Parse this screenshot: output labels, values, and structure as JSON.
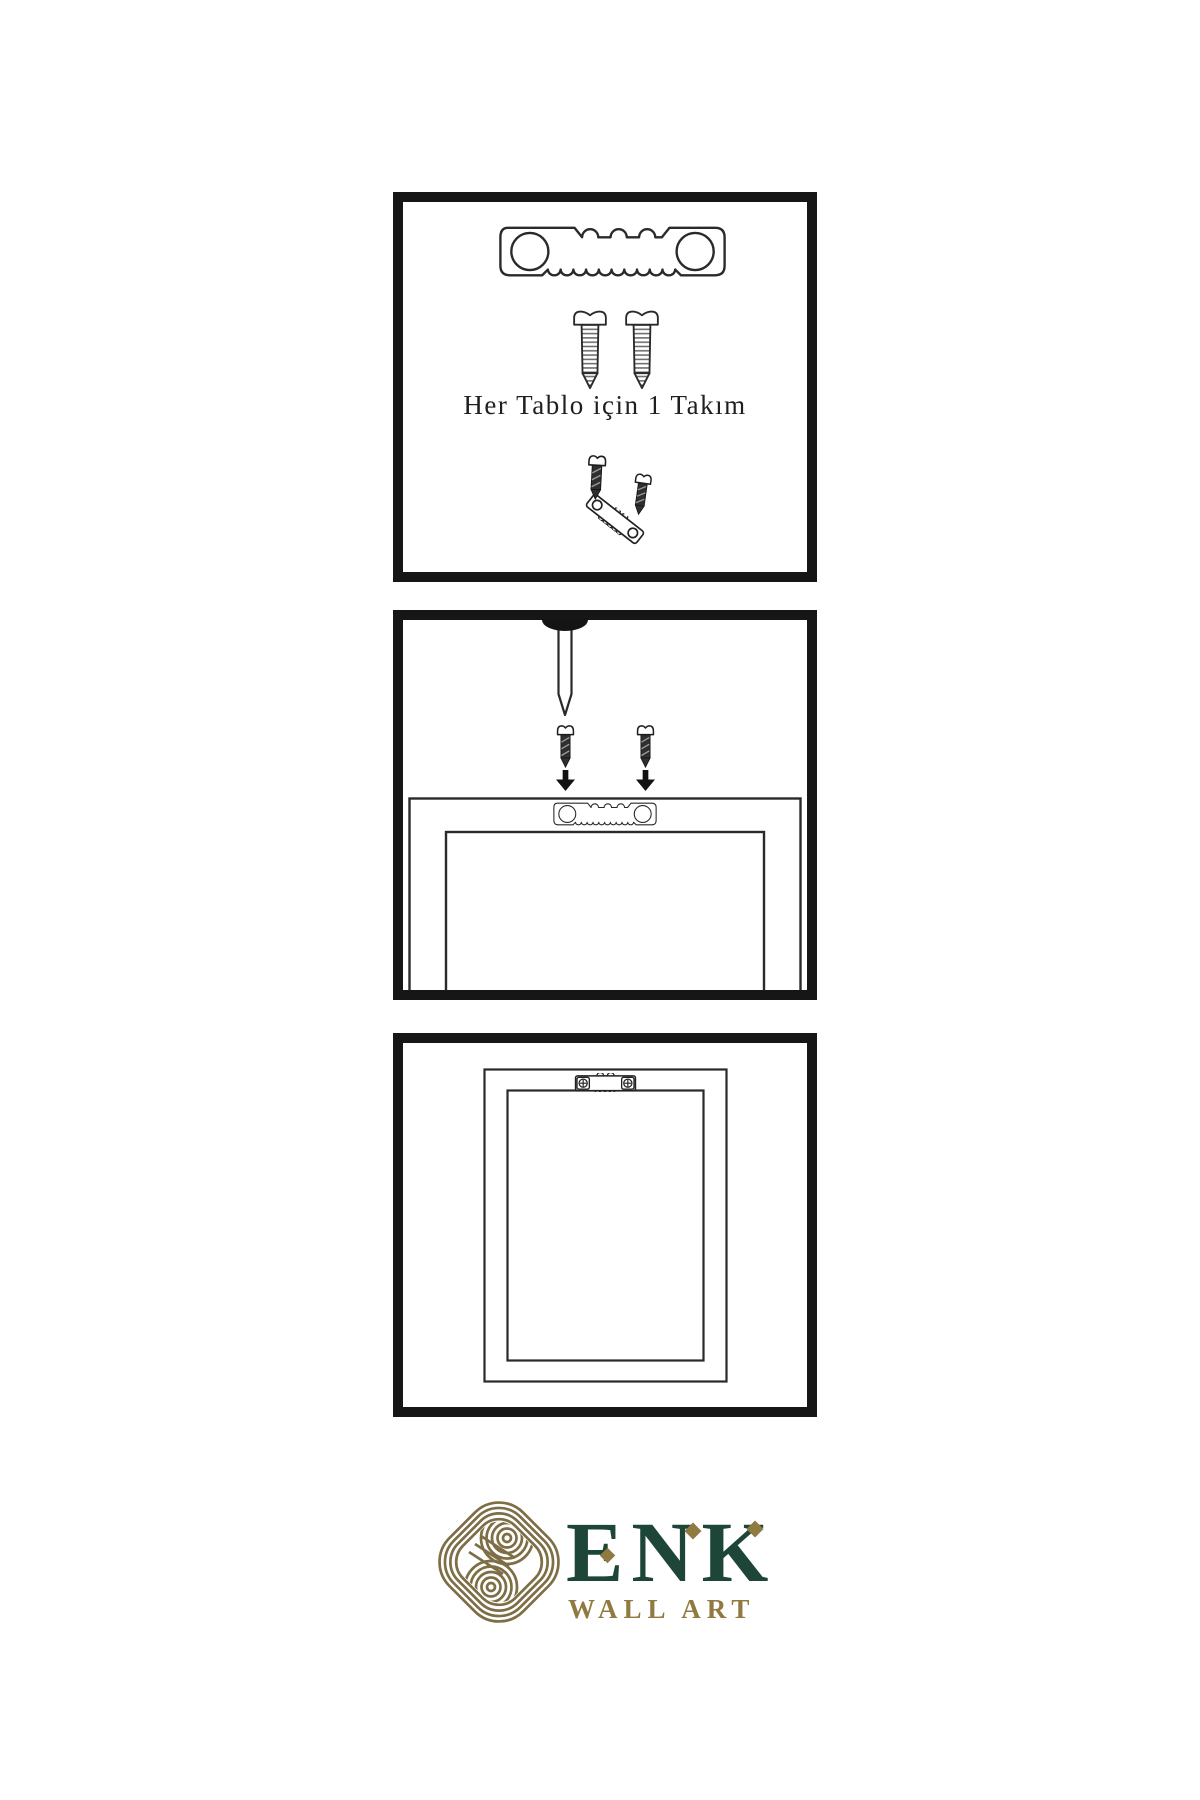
{
  "page": {
    "background": "#ffffff"
  },
  "panels": {
    "kit": {
      "caption": "Her Tablo için 1 Takım",
      "icons": [
        "sawtooth-hanger",
        "screw",
        "screw",
        "screw-into-hanger-demo"
      ]
    },
    "mount": {
      "icons": [
        "wall-nail",
        "dark-screw",
        "dark-screw",
        "down-arrow",
        "down-arrow",
        "frame-back-with-sawtooth-hanger"
      ]
    },
    "hang": {
      "icons": [
        "hung-frame-with-mounted-hanger"
      ]
    }
  },
  "brand": {
    "name": "ENK",
    "subtitle": "WALL ART",
    "name_color": "#1d4639",
    "gold_color": "#7e6e45"
  },
  "colors": {
    "panel_border": "#161616",
    "line_art": "#2a2a2a",
    "text": "#1f1f1f",
    "background": "#ffffff"
  }
}
